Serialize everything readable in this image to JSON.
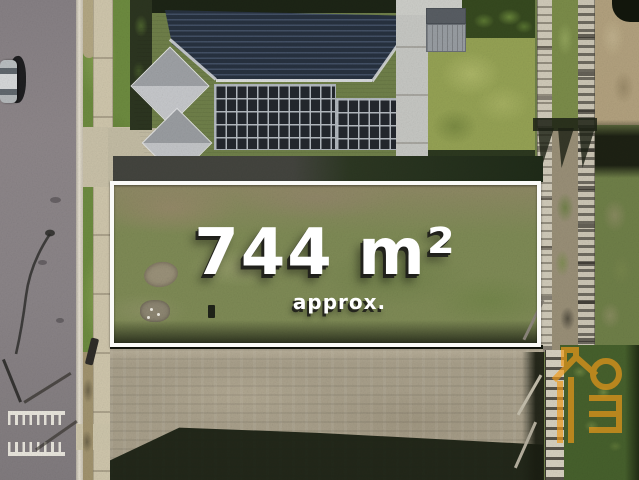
{
  "photo": {
    "kind": "aerial-drone-photo-of-vacant-land",
    "area_label": "744 m²",
    "approx_label": "approx."
  },
  "watermark": {
    "name": "real-estate-logo",
    "color": "#f09a18"
  },
  "palette": {
    "road": "#8b8588",
    "kerb": "#e0dacc",
    "footpath": "#cfc6ac",
    "verge_grass": "#6d8b3f",
    "backyard_lawn": "#95a254",
    "lot_grass": "#7e8a55",
    "graded_dirt": "#a89f8a",
    "roof_dark": "#27313f",
    "roof_light": "#b5b7ba",
    "solar_panel": "#23272d",
    "fence_timber": "#d0cab9",
    "boundary_line": "#fafaf7",
    "shadow": "#1a2012",
    "label_text": "#ffffff"
  }
}
